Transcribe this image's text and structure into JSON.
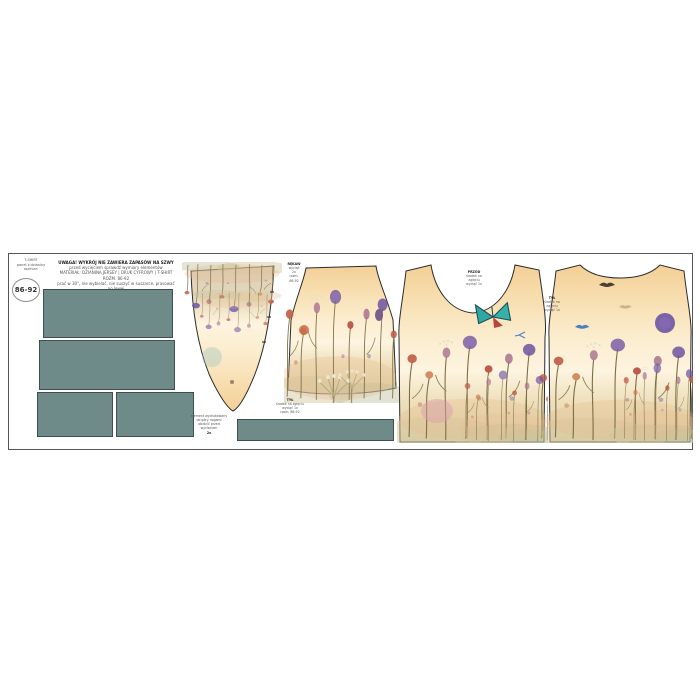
{
  "panel": {
    "size_label": "86-92",
    "size_note_lines": [
      "T-SHIRT",
      "panel z dzianiny",
      "rozmiar:"
    ],
    "header_lines": [
      "UWAGA! WYKRÓJ NIE ZAWIERA ZAPASÓW NA SZWY",
      "przed wycięciem sprawdź wymiary elementów",
      "MATERIAŁ: DZIANINA JERSEY | DRUK CYFROWY | T-SHIRT ROZM. 86-92",
      "prać w 30°, nie wybielać, nie suszyć w suszarce, prasować po lewej"
    ],
    "labels": {
      "sleeve": [
        "RĘKAW",
        "wyciąć",
        "2x",
        "rozm.",
        "86-92"
      ],
      "inverted_piece": [
        "element wydrukowany",
        "do góry nogami",
        "obrócić przed",
        "wycięciem",
        "2x"
      ],
      "center": [
        "TYŁ",
        "środek na zgięciu",
        "wyciąć 1x",
        "rozm. 86-92"
      ],
      "front": [
        "PRZÓD",
        "środek na",
        "zgięciu",
        "wyciąć 1x"
      ],
      "back": [
        "TYŁ",
        "środek na",
        "zgięciu",
        "wyciąć 1x"
      ]
    },
    "pieces": {
      "ribbing": "ściągacz",
      "front": "przód",
      "back": "tył",
      "sleeve": "rękaw"
    },
    "colors": {
      "ribbing_teal": "#6E8A89",
      "ribbing_border": "#3F4F4E",
      "outline": "#2B2B2B",
      "butterfly_teal": "#2FA7A3",
      "sky_peach": "#F3CF96",
      "cream": "#FDF4E0"
    }
  }
}
